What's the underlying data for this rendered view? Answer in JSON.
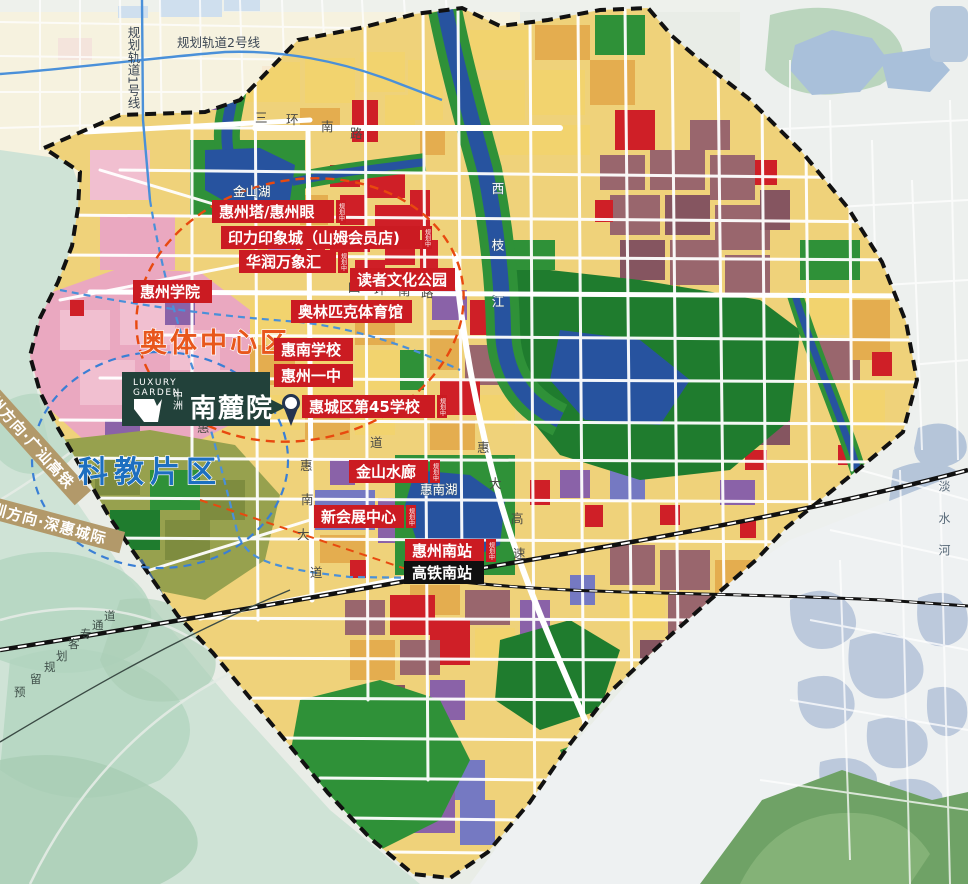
{
  "logo": {
    "brand_line1": "LUXURY",
    "brand_line2": "GARDEN",
    "developer": "中洲",
    "project": "南麓院"
  },
  "districts": {
    "aoti": "奥体中心区",
    "kejiao": "科教片区"
  },
  "pois": [
    {
      "text": "惠州塔/惠州眼",
      "tag": "规划中"
    },
    {
      "text": "印力印象城（山姆会员店)",
      "tag": "规划中"
    },
    {
      "text": "华润万象汇",
      "tag": "规划中"
    },
    {
      "text": "读者文化公园",
      "tag": ""
    },
    {
      "text": "惠州学院",
      "tag": ""
    },
    {
      "text": "奥林匹克体育馆",
      "tag": ""
    },
    {
      "text": "惠南学校",
      "tag": ""
    },
    {
      "text": "惠州一中",
      "tag": ""
    },
    {
      "text": "惠城区第45学校",
      "tag": "规划中"
    },
    {
      "text": "金山水廊",
      "tag": "规划中"
    },
    {
      "text": "新会展中心",
      "tag": "规划中"
    },
    {
      "text": "惠州南站",
      "tag": "规划中"
    }
  ],
  "station": {
    "text": "高铁南站"
  },
  "waters": {
    "jinshanhu": "金山湖",
    "huinanhu": "惠南湖",
    "xizhijiang": "西枝江",
    "danshuihe": "淡水河"
  },
  "roads": {
    "sanhuan": "三环南路",
    "sihuan": "四环南路",
    "huinandadao": "惠南大道",
    "huidagaosu": "惠大高速",
    "dao": "道",
    "hui": "惠"
  },
  "rails": {
    "line1": "规划轨道1号线",
    "line2": "规划轨道2号线",
    "reserved": "预留规划客专通道"
  },
  "banners": {
    "guangshan": "广州方向·广汕高铁",
    "shenhui": "深圳方向·深惠城际"
  },
  "colors": {
    "label_red": "#cb1b22",
    "station_black": "#101010",
    "district_orange": "#e8571c",
    "district_blue": "#1d6fc0",
    "banner_tan": "#b2996a",
    "logo_green": "#22413a",
    "water_blue": "#27539f",
    "park_green": "#2f9138",
    "boundary_black": "#111111",
    "metro_blue": "#4a90d9"
  }
}
